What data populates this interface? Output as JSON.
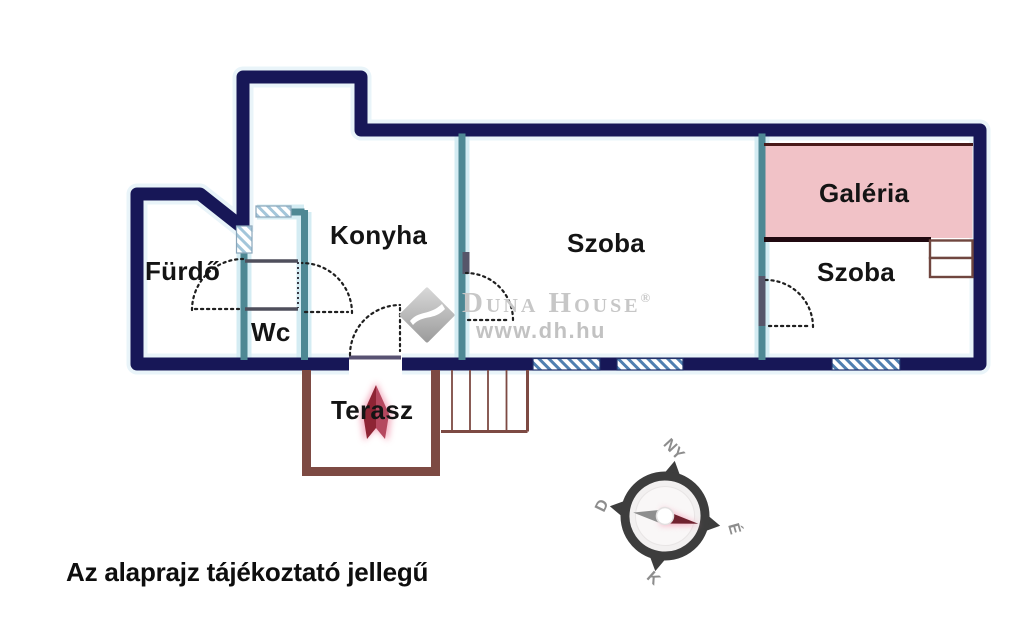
{
  "floorplan": {
    "rooms": {
      "furdo": "Fürdő",
      "wc": "Wc",
      "konyha": "Konyha",
      "szoba_center": "Szoba",
      "galeria": "Galéria",
      "szoba_right": "Szoba",
      "terasz": "Terasz"
    },
    "disclaimer": "Az alaprajz tájékoztató jellegű"
  },
  "watermark": {
    "brand": "Duna House",
    "registered": "®",
    "url": "www.dh.hu"
  },
  "compass": {
    "west": "NY",
    "south": "D",
    "east": "K",
    "north": "É"
  },
  "colors": {
    "outer_wall_navy": "#171757",
    "inner_wall_teal": "#4e8894",
    "wall_glow_blue": "#d4ecf3",
    "window_hatch_blue": "#4f7fb0",
    "window_hatch_light": "#a3c6da",
    "partition_gray": "#4f4f5c",
    "terrace_brown": "#7d4a43",
    "gallery_fill_pink": "#f1c2c7",
    "gallery_line_dark": "#2a0d12",
    "arrow_red": "#8e2434",
    "compass_ring_gray": "#3d3d3d",
    "compass_needle_maroon": "#70222f",
    "watermark_gray": "#c7c7c7",
    "label_black": "#141414"
  }
}
